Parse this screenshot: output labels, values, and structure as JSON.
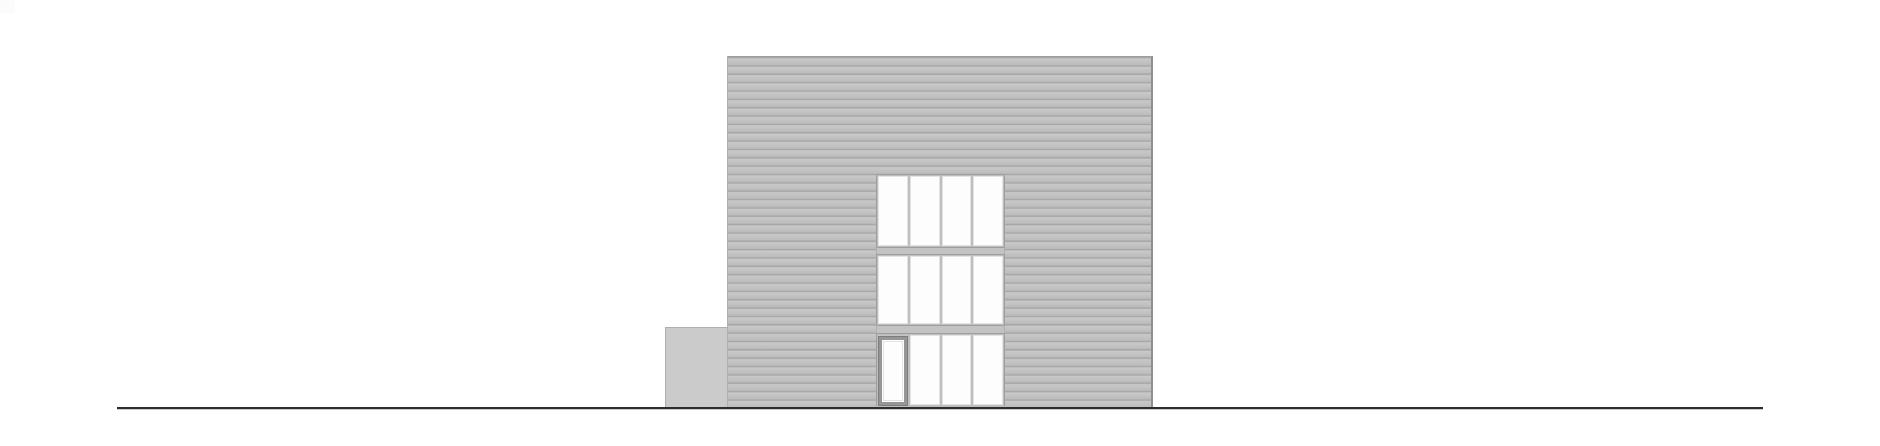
{
  "drawing": {
    "kind": "architectural-elevation",
    "visible_text": []
  },
  "colors": {
    "background": "#ffffff",
    "corner_artifact": "#fbfbfb",
    "facade_base": "#c3c3c3",
    "facade_line": "#a8a8a8",
    "annex_fill": "#cbcbcb",
    "annex_edge": "#b0b0b0",
    "building_edge": "#8f8f8f",
    "band_border": "#9e9e9e",
    "mullion": "#bebebe",
    "spandrel": "#c3c3c3",
    "window_pane": "#fdfdfd",
    "window_frame": "#e3e3e3",
    "door_frame": "#969696",
    "door_frame_edge": "#7d7d7d",
    "ground_line": "#2d2d2d"
  },
  "elevation": {
    "siding": "horizontal-clapboard",
    "siding_period_px": 8.35,
    "floors": [
      {
        "name": "second-floor",
        "panes": 4,
        "door": false
      },
      {
        "name": "first-floor",
        "panes": 4,
        "door": false
      },
      {
        "name": "ground-floor",
        "panes": 4,
        "door": true
      }
    ],
    "annex_present": true,
    "ground_line_present": true
  }
}
